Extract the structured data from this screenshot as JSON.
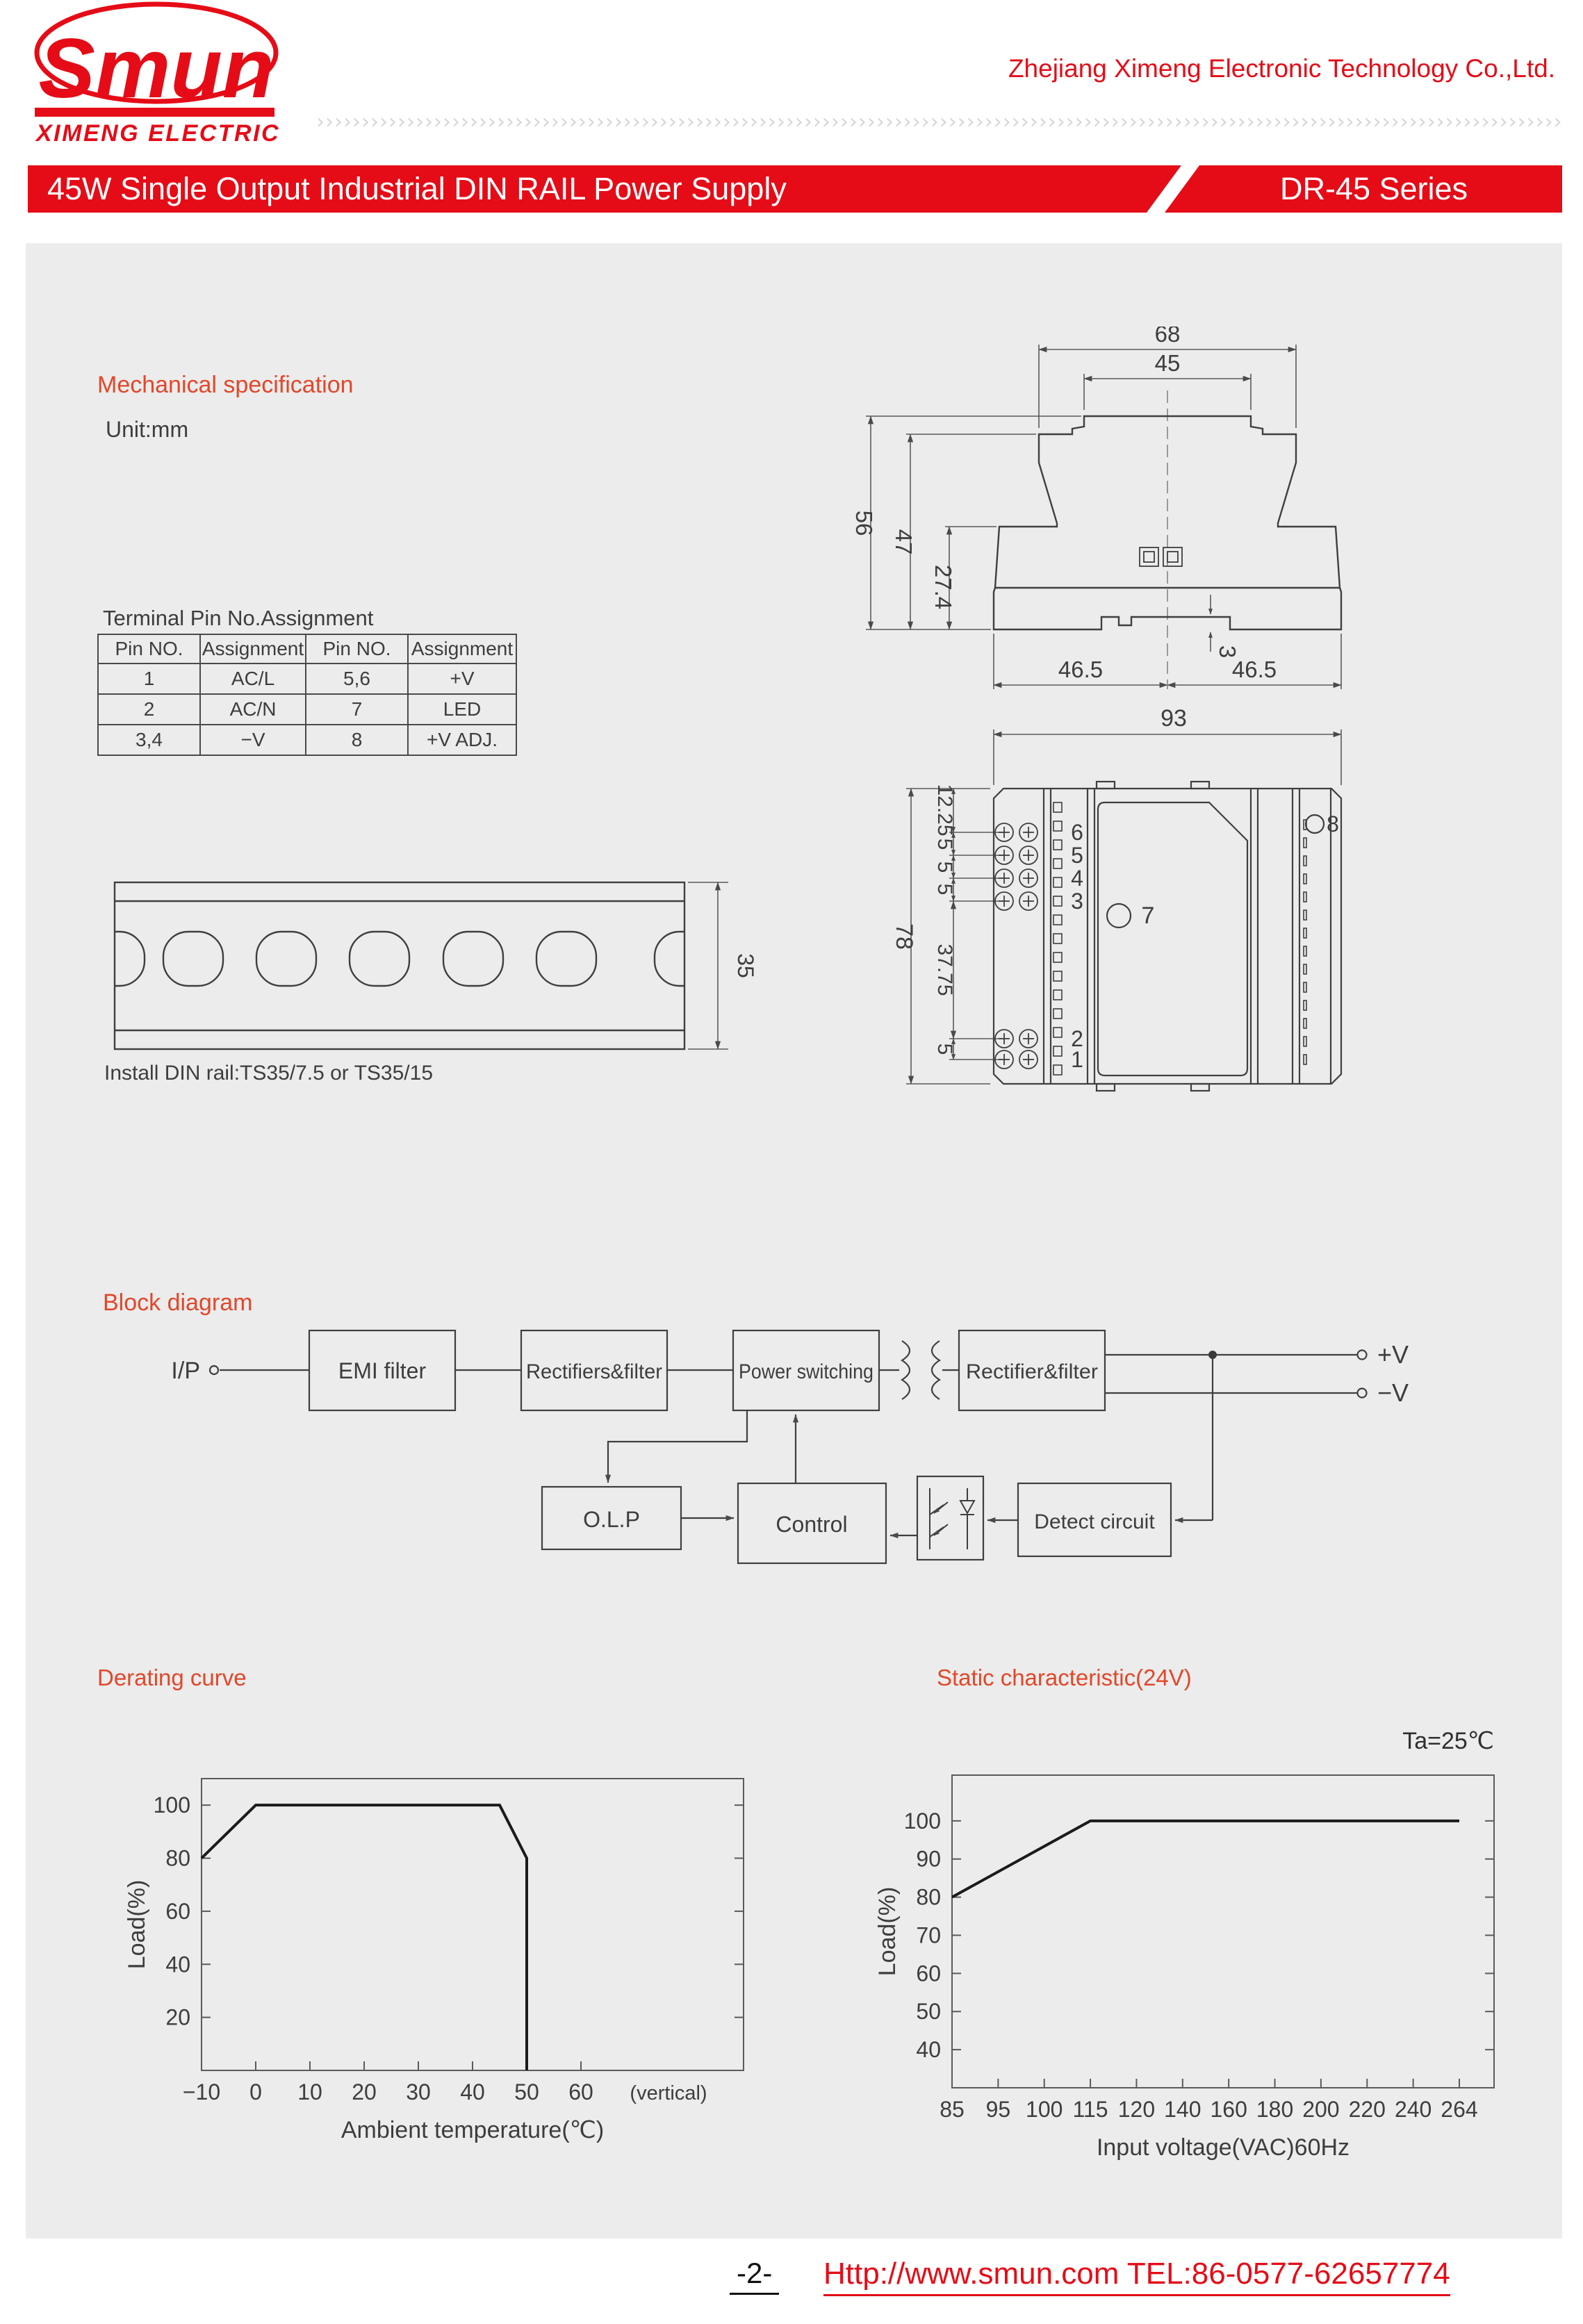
{
  "colors": {
    "brand_red": "#e50c17",
    "section_red": "#e2472a",
    "content_bg": "#ececec",
    "line_dark": "#3f3f3f"
  },
  "header": {
    "logo_text": "Smun",
    "logo_subtext": "XIMENG ELECTRIC",
    "company": "Zhejiang Ximeng Electronic Technology Co.,Ltd.",
    "chevron_char": "›",
    "banner_title": "45W Single Output Industrial DIN RAIL Power Supply",
    "banner_series": "DR-45 Series"
  },
  "mechanical": {
    "section_title": "Mechanical specification",
    "unit": "Unit:mm",
    "side_view": {
      "overall_width": "68",
      "top_width": "45",
      "total_height": "56",
      "body_height": "47",
      "lower_height": "27.4",
      "bottom_left": "46.5",
      "bottom_right": "46.5",
      "rail_step": "3"
    },
    "front_view": {
      "overall_width": "93",
      "overall_height": "78",
      "chain": [
        "12.25",
        "5",
        "5",
        "5",
        "37.75",
        "5"
      ],
      "pins_top": [
        "6",
        "5",
        "4",
        "3"
      ],
      "pins_bottom": [
        "2",
        "1"
      ],
      "led_pin": "7",
      "adj_pin": "8"
    },
    "din_rail": {
      "height": "35",
      "caption": "Install DIN rail:TS35/7.5 or TS35/15"
    }
  },
  "pin_table": {
    "title": "Terminal Pin No.Assignment",
    "headers": [
      "Pin NO.",
      "Assignment",
      "Pin NO.",
      "Assignment"
    ],
    "rows": [
      [
        "1",
        "AC/L",
        "5,6",
        "+V"
      ],
      [
        "2",
        "AC/N",
        "7",
        "LED"
      ],
      [
        "3,4",
        "−V",
        "8",
        "+V ADJ."
      ]
    ]
  },
  "block_diagram": {
    "section_title": "Block diagram",
    "input_label": "I/P",
    "boxes": {
      "emi": "EMI filter",
      "rect1": "Rectifiers&filter",
      "power": "Power switching",
      "rect2": "Rectifier&filter",
      "olp": "O.L.P",
      "control": "Control",
      "detect": "Detect circuit"
    },
    "outputs": {
      "pos": "+V",
      "neg": "−V"
    }
  },
  "chart_data": [
    {
      "type": "line",
      "title": "Derating curve",
      "xlabel": "Ambient temperature(℃)",
      "ylabel": "Load(%)",
      "x_ticks": [
        -10,
        0,
        10,
        20,
        30,
        40,
        50,
        60
      ],
      "x_suffix_label": "(vertical)",
      "y_ticks": [
        20,
        40,
        60,
        80,
        100
      ],
      "xlim": [
        -10,
        90
      ],
      "ylim": [
        0,
        110
      ],
      "grid": false,
      "legend": false,
      "series": [
        {
          "name": "Load",
          "points": [
            [
              -10,
              80
            ],
            [
              0,
              100
            ],
            [
              45,
              100
            ],
            [
              50,
              80
            ],
            [
              50,
              0
            ]
          ]
        }
      ]
    },
    {
      "type": "line",
      "title": "Static characteristic(24V)",
      "annotation": "Ta=25℃",
      "xlabel": "Input voltage(VAC)60Hz",
      "ylabel": "Load(%)",
      "x_ticks": [
        85,
        95,
        100,
        115,
        120,
        140,
        160,
        180,
        200,
        220,
        240,
        264
      ],
      "x_scale": "categorical",
      "y_ticks": [
        40,
        50,
        60,
        70,
        80,
        90,
        100
      ],
      "ylim": [
        30,
        112
      ],
      "grid": false,
      "legend": false,
      "series": [
        {
          "name": "Load",
          "points": [
            [
              85,
              80
            ],
            [
              115,
              100
            ],
            [
              264,
              100
            ]
          ]
        }
      ]
    }
  ],
  "footer": {
    "page": "-2-",
    "link": "Http://www.smun.com   TEL:86-0577-62657774"
  }
}
